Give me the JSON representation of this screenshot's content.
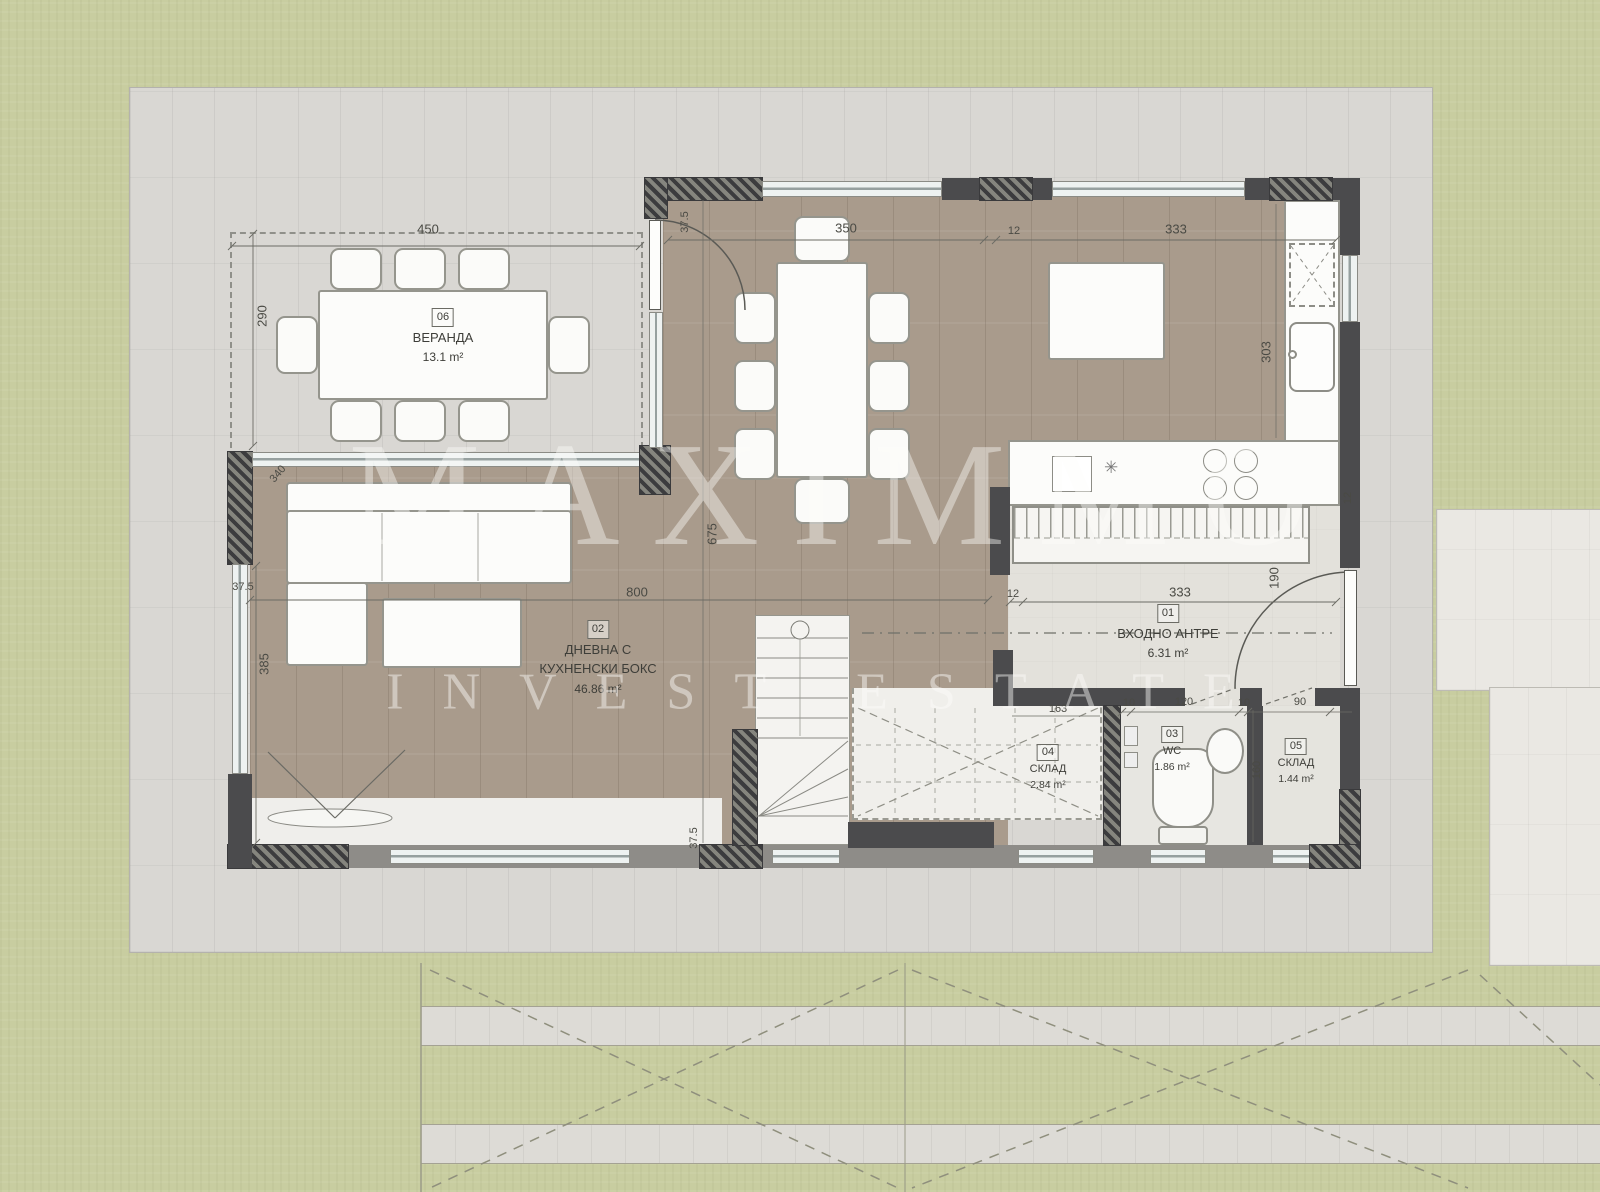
{
  "watermark": {
    "line1": "MAXIMMO",
    "line2": "INVEST ESTATE"
  },
  "rooms": {
    "veranda": {
      "num": "06",
      "name": "ВЕРАНДА",
      "area": "13.1 m²"
    },
    "living": {
      "num": "02",
      "name1": "ДНЕВНА С",
      "name2": "КУХНЕНСКИ БОКС",
      "area": "46.86 m²"
    },
    "hall": {
      "num": "01",
      "name": "ВХОДНО АНТРЕ",
      "area": "6.31 m²"
    },
    "wc": {
      "num": "03",
      "name": "WC",
      "area": "1.86 m²"
    },
    "storage4": {
      "num": "04",
      "name": "СКЛАД",
      "area": "2.84 m²"
    },
    "storage5": {
      "num": "05",
      "name": "СКЛАД",
      "area": "1.44 m²"
    }
  },
  "dimensions": {
    "veranda_width": "450",
    "veranda_depth": "290",
    "wall_thickness_top": "37.5",
    "dining_span": "350",
    "gap_top": "12",
    "kitchen_span": "333",
    "corner_diag": "340",
    "wall_thickness_left": "37.5",
    "living_left_depth": "385",
    "living_width": "800",
    "living_depth": "675",
    "kitchen_depth": "303",
    "hall_gap": "12",
    "hall_span": "333",
    "entry_door": "190",
    "kitchen_corner": "12",
    "stair_wall": "37.5",
    "storage_span": "163",
    "wc_wall_a": "10",
    "wc_width": "120",
    "wc_wall_b": "10",
    "storage5_width": "90",
    "wc_depth": "160"
  },
  "symbols": {
    "counter_mark": "✳"
  },
  "colors": {
    "grass": "#c8cda0",
    "paving": "#d9d7d3",
    "wood_floor": "#a99b8c",
    "stone_floor": "#e3e1db",
    "wall_dark": "#4b4b4d",
    "window_glass": "#eef2f1"
  }
}
